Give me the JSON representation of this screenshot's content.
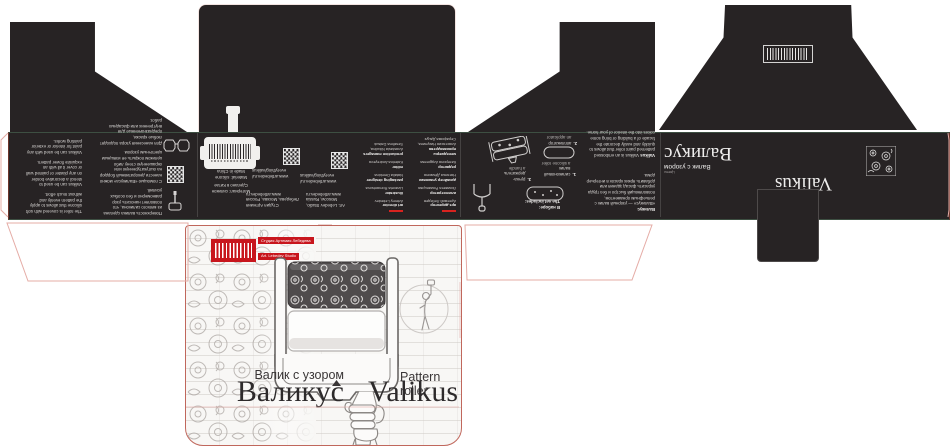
{
  "product": {
    "title_ru": "Валикус",
    "title_en": "Valikus",
    "subtitle_ru": "Валик с узором",
    "subtitle_en": "Pattern roller",
    "pattern_ru": "Цветы",
    "pattern_en": "Flowers"
  },
  "studio": {
    "name_ru": "Студия Артемия Лебедева",
    "name_en": "Art. Lebedev Studio",
    "address_ru": "Студия Артемия Лебедева, Москва, Россия",
    "address_en": "Art. Lebedev Studio, Moscow, Russia",
    "site": "www.artlebedev.ru",
    "store_line1": "www.artlebedev.ru/",
    "store_line2": "everything/valikus"
  },
  "features": {
    "en": [
      "The roller is covered with soft silicone that allows to apply the pattern evenly and without much effort.",
      "Valikus can be used to stencil a decorative border on any plaster or painted wall or cover it all with an exquisite flower pattern.",
      "Valikus can be used with any paint for interior or exterior painting works."
    ],
    "ru": [
      "Поверхность валика сделана из мягкого силикона, что позволяет наносить узор равномерно и без особых усилий.",
      "С помощью «Валикуса» можно нанести декоративный бордюр на оштукатуренную или окрашенную стену либо целиком покрыть её изящным цветочным узором.",
      "Для нанесения узора подходят любые краски, предназначенные для внутренних или фасадных работ."
    ]
  },
  "about": {
    "heading_ru": "Валикус",
    "text_ru": "«Валикус» — узорный валик с рельефным орнаментом, позволяющий быстро и без труда украсить фасад здания или добавить ярких красок в интерьер дома.",
    "heading_en": "Valikus",
    "text_en": "Valikus is an embossed patterned paint roller that allows to quickly and easily decorate the facade of a building or bring some colors into the interior of your home."
  },
  "set": {
    "heading_ru": "В наборе:",
    "heading_en": "The set includes:",
    "items": [
      {
        "num": "1.",
        "ru": "силиконовый валик",
        "en": "a silicone roller"
      },
      {
        "num": "2.",
        "ru": "аппликатор",
        "en": "an applicator"
      },
      {
        "num": "3.",
        "ru": "ручка-держатель",
        "en": "a handle"
      }
    ]
  },
  "specs": {
    "material_ru": "Материал: силикон",
    "made_ru": "Сделано в Китае",
    "material_en": "Material: silicone",
    "made_en": "Made in China"
  },
  "credits": {
    "en": [
      {
        "role": "art director",
        "name": "Artemy Lebedev"
      },
      {
        "role": "illustrator",
        "name": "Lizaveta Romantsova"
      },
      {
        "role": "packaging designer",
        "name": "Natalia Demkina"
      },
      {
        "role": "editor",
        "name": "Katerina Andreyeva"
      },
      {
        "role": "production managers",
        "name": "Anastasia Nikulina, Serafima Datsuk"
      }
    ],
    "ru": [
      {
        "role": "арт-директор",
        "name": "Артемий Лебедев"
      },
      {
        "role": "иллюстратор",
        "name": "Лизавета Романцова"
      },
      {
        "role": "дизайнер упаковки",
        "name": "Наталья Дёмкина"
      },
      {
        "role": "редактор",
        "name": "Катерина Андреева"
      },
      {
        "role": "менеджеры производства",
        "name": "Анастасия Никулина, Серафима Дацук"
      }
    ]
  },
  "colors": {
    "accent_red": "#c8161d",
    "panel_black": "#272324",
    "dieline_red": "#b5544a",
    "dieline_pink": "#e5aca6",
    "fold_green": "#3d4f42"
  }
}
